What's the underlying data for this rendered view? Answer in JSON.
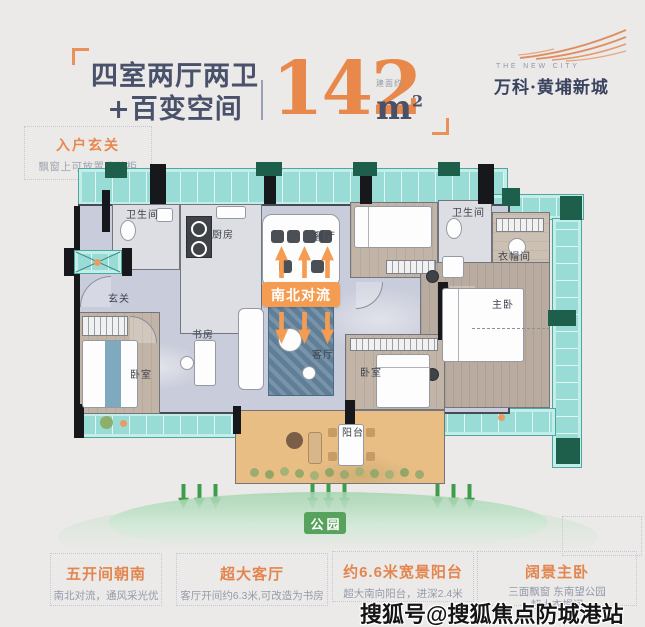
{
  "header": {
    "title_line1": "四室两厅两卫",
    "title_line2": "+百变空间",
    "area_value": "142",
    "area_note": "建面约",
    "area_unit": "m",
    "area_exp": "2"
  },
  "brand": {
    "name_en": "THE NEW CITY",
    "name_cn": "万科·黄埔新城"
  },
  "callout": {
    "title": "入户玄关",
    "desc": "飘窗上可放置收纳柜"
  },
  "plan": {
    "flow_badge": "南北对流",
    "park_badge": "公园",
    "rooms": {
      "bath1": "卫生间",
      "kitchen": "厨房",
      "dining": "餐厅",
      "foyer": "玄关",
      "study": "书房",
      "living": "客厅",
      "bedroom_left": "卧室",
      "bedroom_mid": "卧室",
      "bath2": "卫生间",
      "closet": "衣帽间",
      "master": "主卧",
      "balcony": "阳台"
    }
  },
  "features": [
    {
      "title": "五开间朝南",
      "desc": "南北对流，通风采光优",
      "desc2": ""
    },
    {
      "title": "超大客厅",
      "desc": "客厅开间约6.3米,可改造为书房",
      "desc2": ""
    },
    {
      "title": "约6.6米宽景阳台",
      "desc": "超大南向阳台，进深2.4米",
      "desc2": ""
    },
    {
      "title": "阔景主卧",
      "desc": "三面飘窗 东南望公园",
      "desc2": "超大衣帽间"
    }
  ],
  "watermark": "搜狐号@搜狐焦点防城港站",
  "colors": {
    "accent_orange": "#e8884b",
    "badge_orange": "#f49c52",
    "park_green": "#57a35d",
    "arrow_green": "#3e9c4c",
    "window_teal": "#98dcd5",
    "title_navy": "#4a516b"
  }
}
